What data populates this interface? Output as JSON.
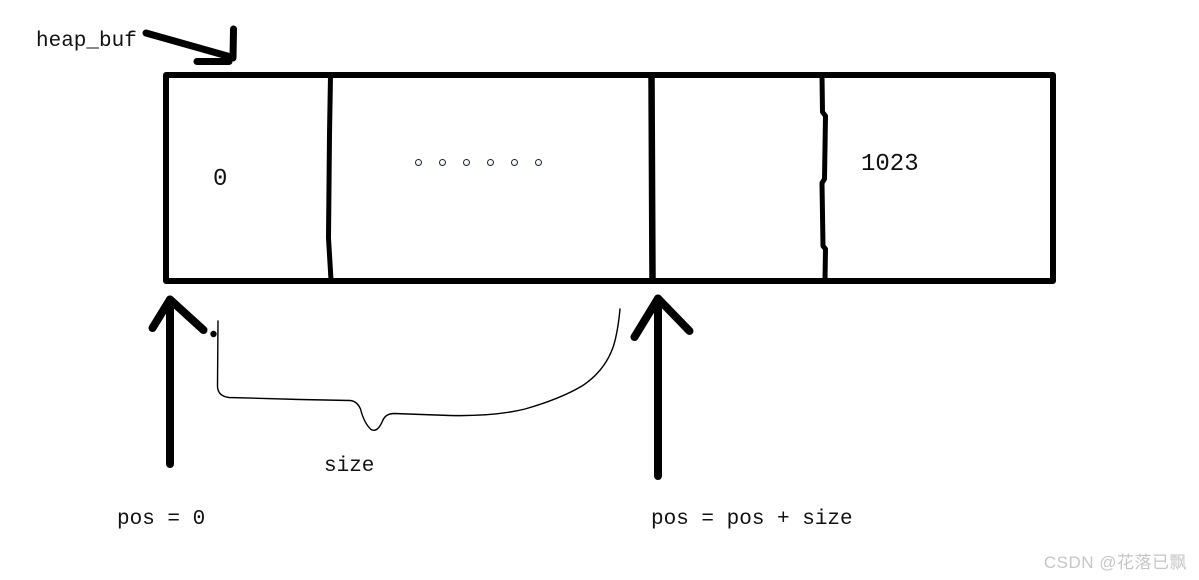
{
  "diagram": {
    "title_label": "heap_buf",
    "buffer": {
      "first_index": "0",
      "last_index": "1023",
      "ellipsis_dot_count": 6
    },
    "annotations": {
      "size_label": "size",
      "pos_start_label": "pos = 0",
      "pos_advance_label": "pos = pos + size"
    }
  },
  "watermark": {
    "text": "CSDN @花落已飘",
    "color": "#c6c6c6"
  },
  "colors": {
    "ink": "#000000",
    "background": "#ffffff"
  }
}
